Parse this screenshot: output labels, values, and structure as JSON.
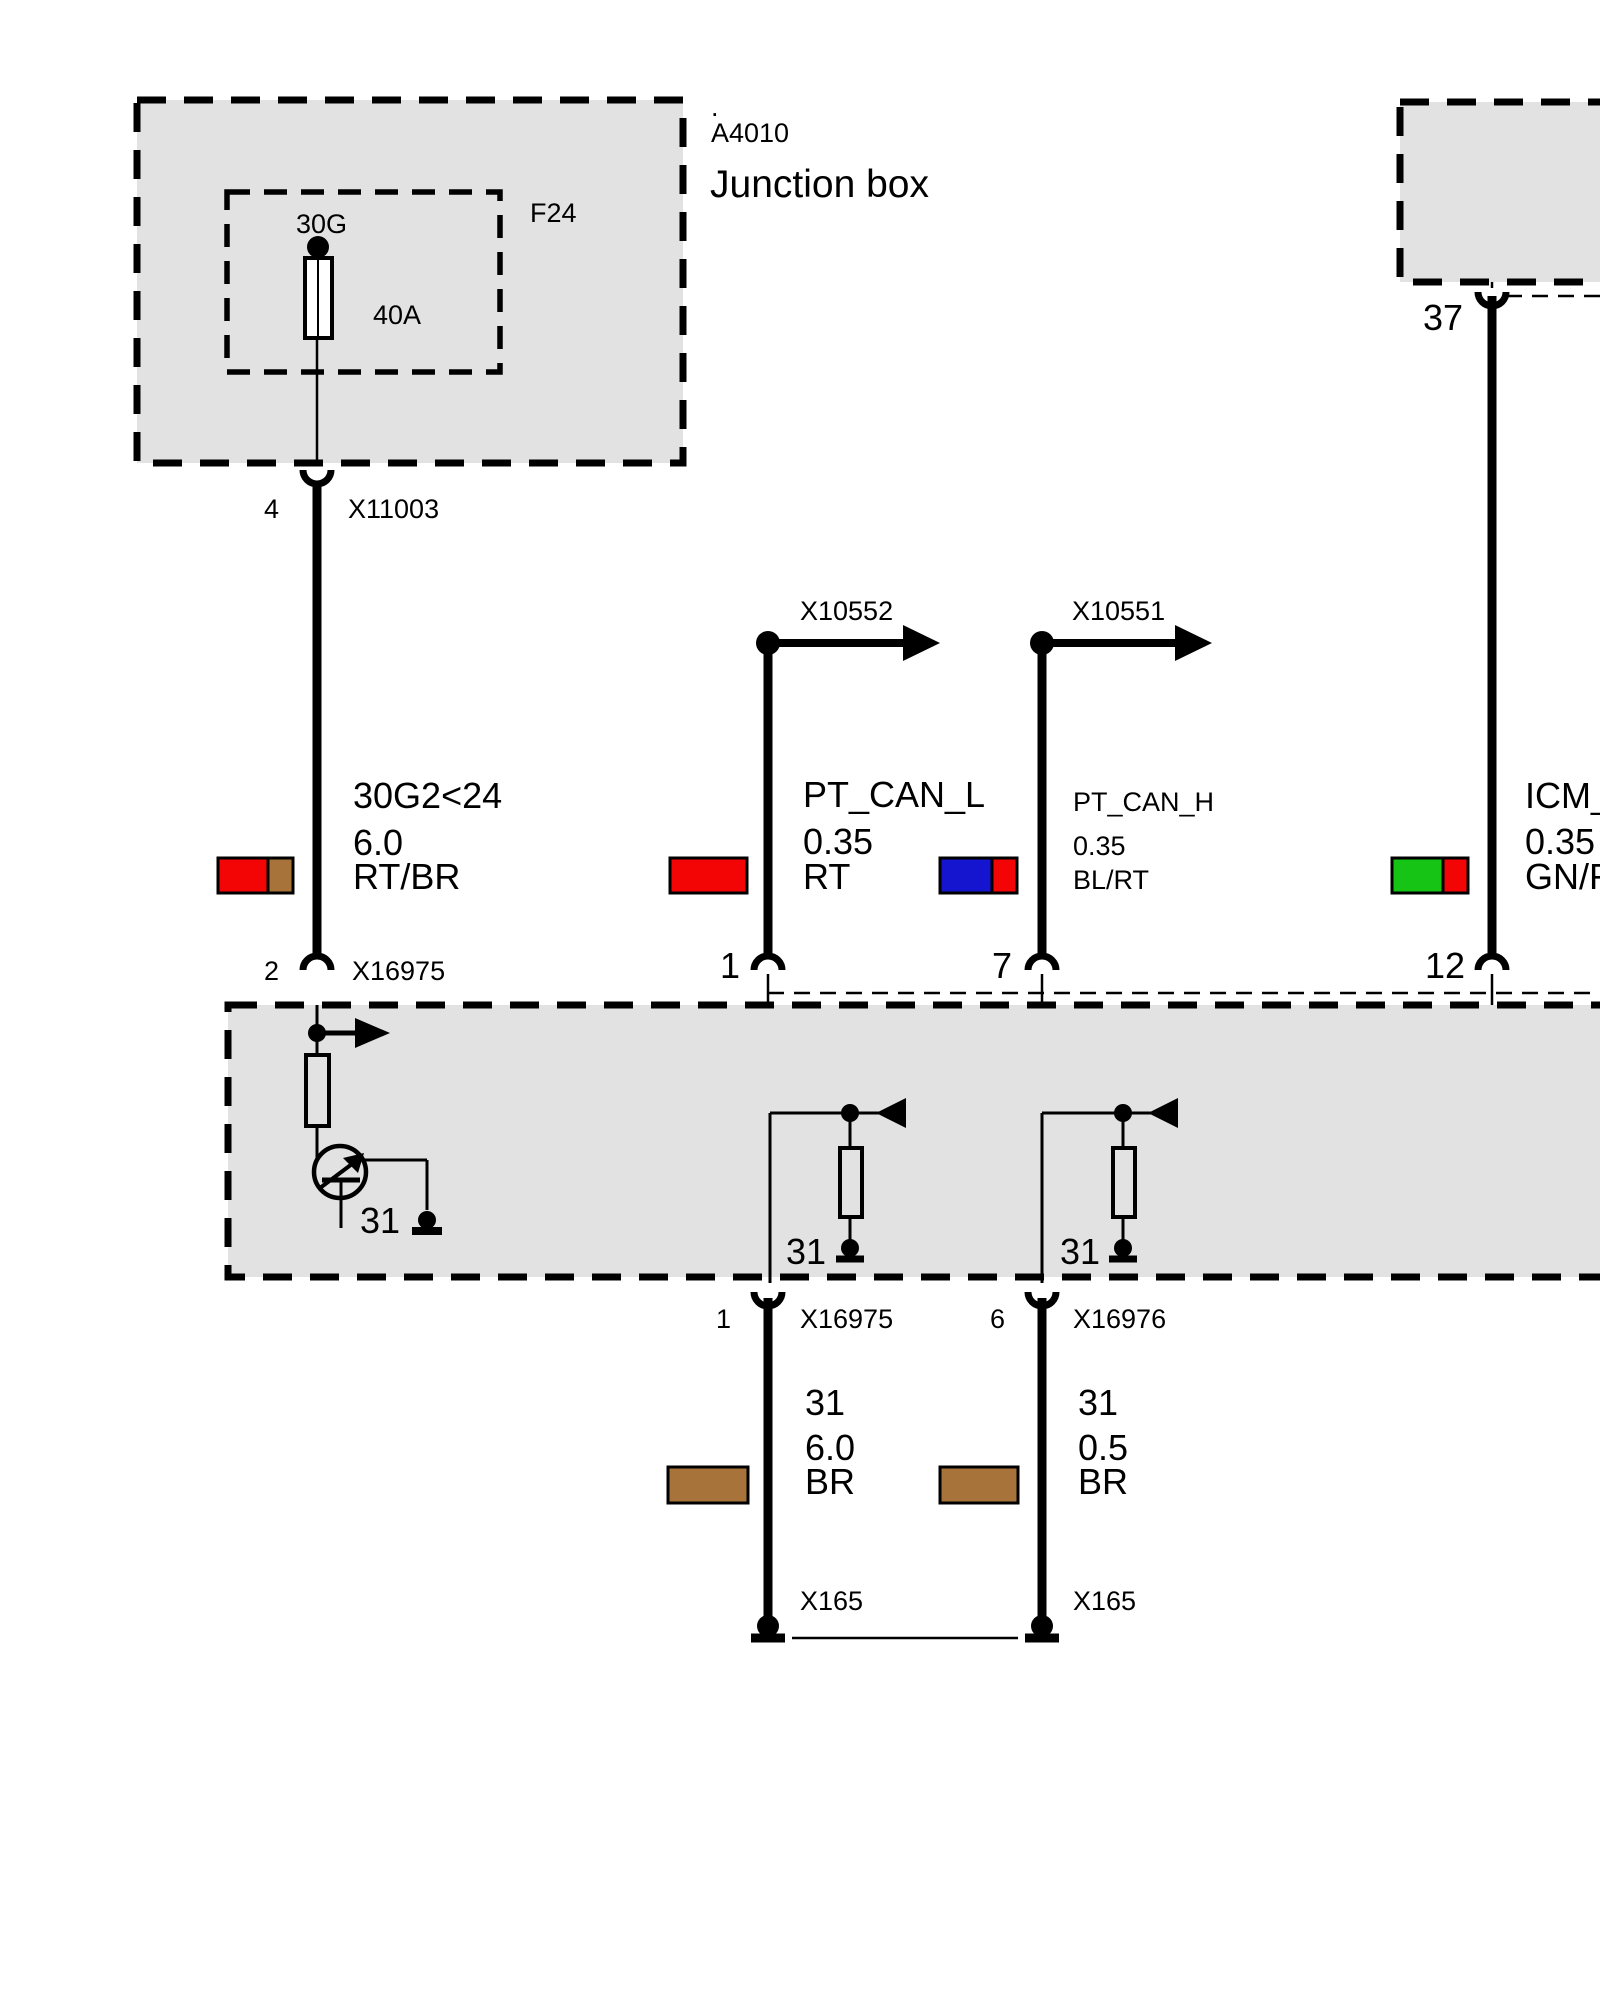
{
  "colors": {
    "box_fill": "#e2e2e2",
    "red": "#f40505",
    "brown": "#a8733a",
    "blue": "#1515cf",
    "green": "#15c415"
  },
  "junction_box": {
    "dot": ".",
    "id": "A4010",
    "title": "Junction box",
    "fuse_slot": "F24",
    "fuse_circuit": "30G",
    "fuse_rating": "40A",
    "out_pin": "4",
    "out_connector": "X11003"
  },
  "module_top_right": {
    "out_pin": "37"
  },
  "branch_connectors": {
    "left": "X10552",
    "right": "X10551"
  },
  "wires": {
    "power": {
      "circuit": "30G2<24",
      "gauge": "6.0",
      "color_code": "RT/BR",
      "module_pin": "2",
      "module_connector": "X16975"
    },
    "can_low": {
      "circuit": "PT_CAN_L",
      "gauge": "0.35",
      "color_code": "RT",
      "module_pin": "1"
    },
    "can_high": {
      "circuit": "PT_CAN_H",
      "gauge": "0.35",
      "color_code": "BL/RT",
      "module_pin": "7"
    },
    "icm": {
      "circuit": "ICM_",
      "gauge": "0.35",
      "color_code": "GN/R",
      "module_pin": "12"
    }
  },
  "module_main": {
    "transistor_ground": "31",
    "resistor_a_ground": "31",
    "resistor_b_ground": "31"
  },
  "ground_wires": {
    "left": {
      "pin": "1",
      "connector": "X16975",
      "circuit": "31",
      "gauge": "6.0",
      "color_code": "BR",
      "ground_connector": "X165"
    },
    "right": {
      "pin": "6",
      "connector": "X16976",
      "circuit": "31",
      "gauge": "0.5",
      "color_code": "BR",
      "ground_connector": "X165"
    }
  }
}
